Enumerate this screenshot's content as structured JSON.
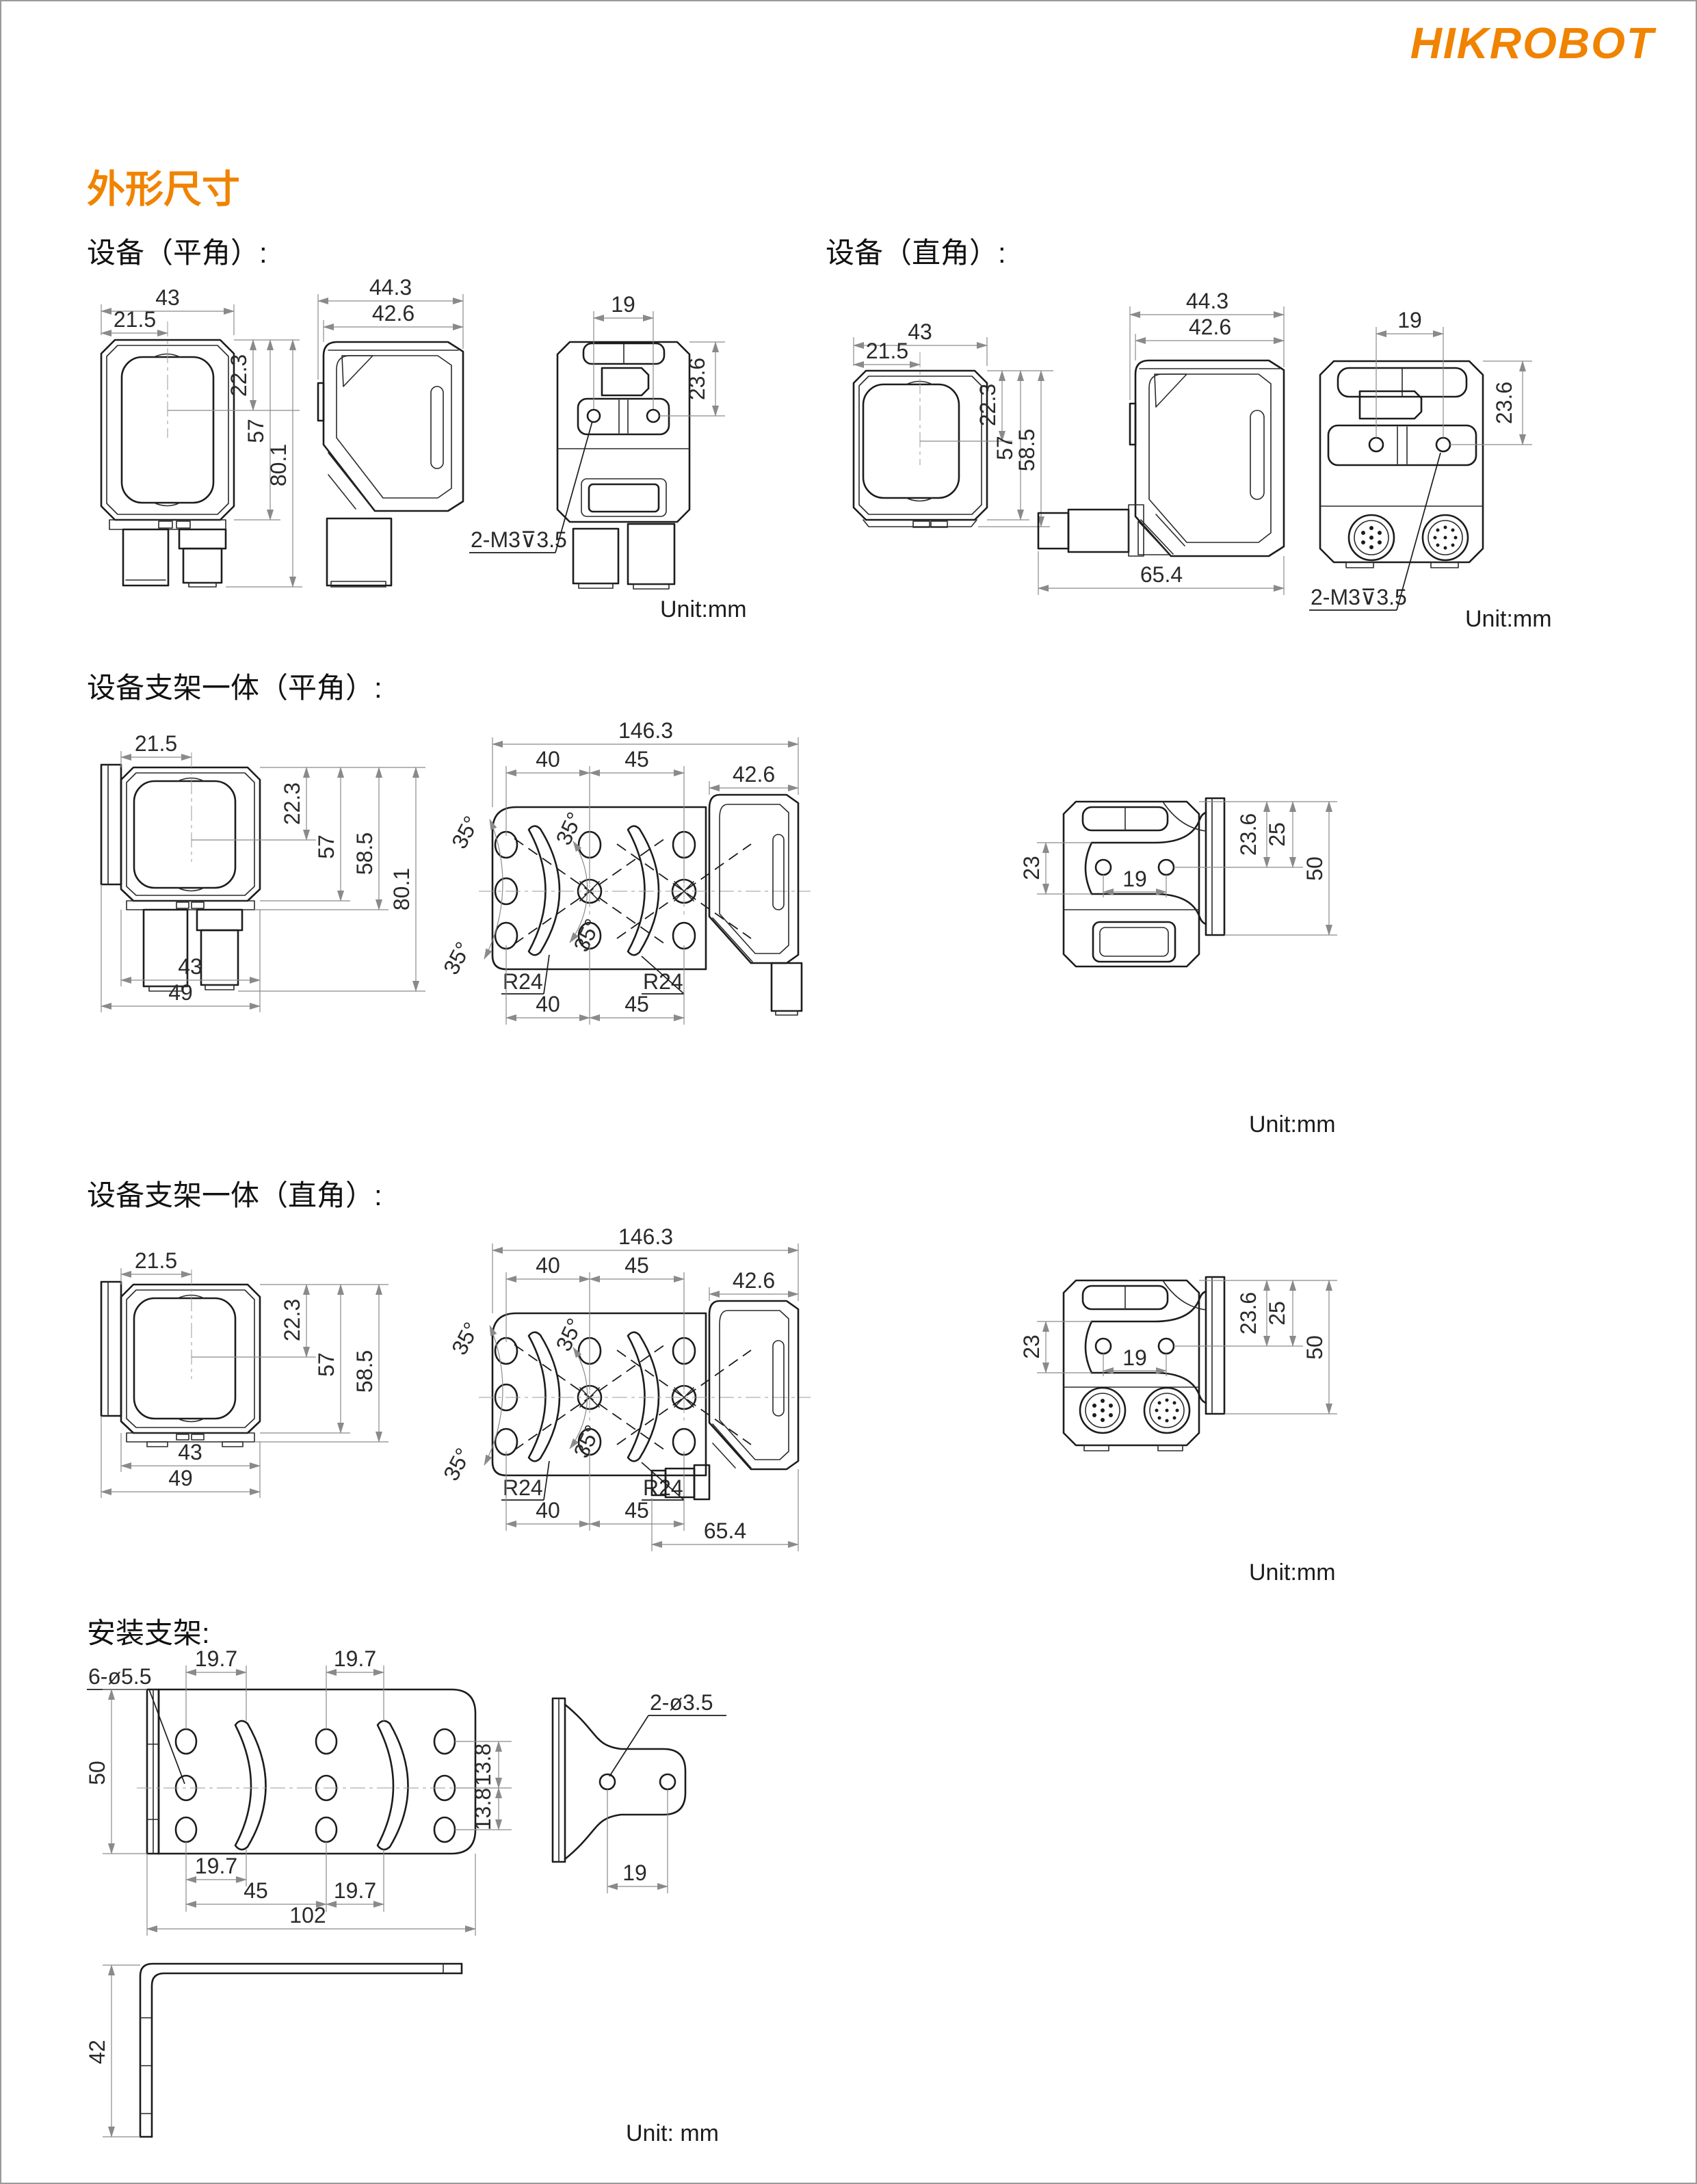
{
  "page": {
    "logo": "HIKROBOT",
    "title": "外形尺寸"
  },
  "s1": {
    "label": "设备（平角）:",
    "unit": "Unit:mm",
    "front": {
      "d43": "43",
      "d215": "21.5",
      "d223": "22.3",
      "d57": "57",
      "d801": "80.1"
    },
    "side": {
      "d443": "44.3",
      "d426": "42.6"
    },
    "rear": {
      "d19": "19",
      "d236": "23.6",
      "note": "2-M3⊽3.5"
    }
  },
  "s2": {
    "label": "设备（直角）:",
    "unit": "Unit:mm",
    "front": {
      "d43": "43",
      "d215": "21.5",
      "d223": "22.3",
      "d57": "57",
      "d585": "58.5"
    },
    "side": {
      "d443": "44.3",
      "d426": "42.6",
      "d654": "65.4"
    },
    "rear": {
      "d19": "19",
      "d236": "23.6",
      "note": "2-M3⊽3.5"
    }
  },
  "s3": {
    "label": "设备支架一体（平角）:",
    "unit": "Unit:mm",
    "front": {
      "d215": "21.5",
      "d223": "22.3",
      "d57": "57",
      "d585": "58.5",
      "d801": "80.1",
      "d43": "43",
      "d49": "49"
    },
    "plate": {
      "d1463": "146.3",
      "d40": "40",
      "d45": "45",
      "d426": "42.6",
      "a35": "35°",
      "r24": "R24"
    },
    "rear": {
      "d23": "23",
      "d19": "19",
      "d236": "23.6",
      "d25": "25",
      "d50": "50"
    }
  },
  "s4": {
    "label": "设备支架一体（直角）:",
    "unit": "Unit:mm",
    "front": {
      "d215": "21.5",
      "d223": "22.3",
      "d57": "57",
      "d585": "58.5",
      "d43": "43",
      "d49": "49"
    },
    "plate": {
      "d1463": "146.3",
      "d40": "40",
      "d45": "45",
      "d426": "42.6",
      "a35": "35°",
      "r24": "R24",
      "d654": "65.4"
    },
    "rear": {
      "d23": "23",
      "d19": "19",
      "d236": "23.6",
      "d25": "25",
      "d50": "50"
    }
  },
  "s5": {
    "label": "安装支架:",
    "unit": "Unit: mm",
    "plate": {
      "note": "6-ø5.5",
      "t1": "19.7",
      "t2": "19.7",
      "left": "50",
      "r1": "13.8",
      "r2": "13.8",
      "b1": "19.7",
      "b2": "45",
      "b3": "19.7",
      "b4": "102"
    },
    "clamp": {
      "note": "2-ø3.5",
      "d19": "19"
    },
    "angle": {
      "d42": "42"
    }
  }
}
